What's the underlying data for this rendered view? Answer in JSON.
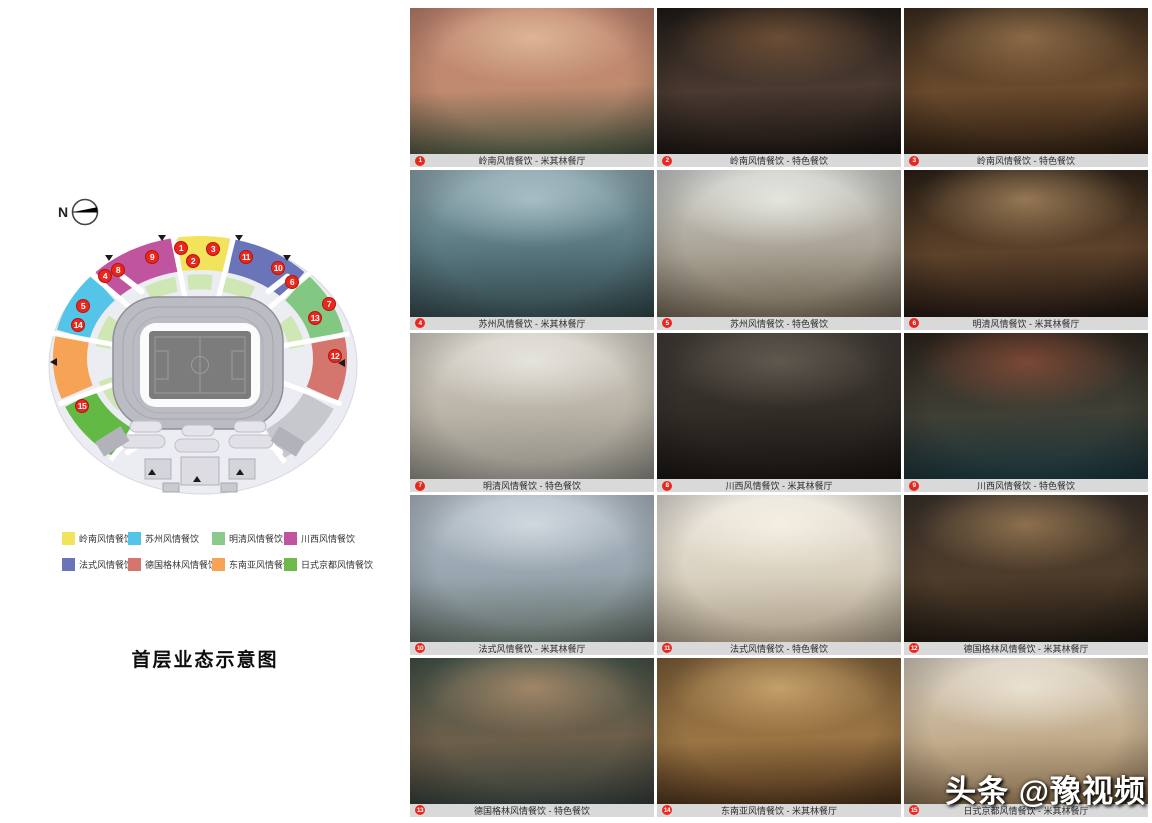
{
  "map_panel": {
    "north_label": "N",
    "title": "首层业态示意图",
    "colors": {
      "lingnan_yellow": "#f2e35c",
      "suzhou_cyan": "#55c4e9",
      "mingqing_green": "#82c882",
      "chuanxi_magenta": "#c0549e",
      "fashi_blue": "#6a74b8",
      "german_salmon": "#d4766e",
      "dongnanya_orange": "#f6a356",
      "rishi_green": "#62b944",
      "inner_ring_green": "#cfe7b4",
      "concourse": "#ececf3",
      "service_gray": "#c7c7ce",
      "badge_red": "#e8281e"
    },
    "legend": {
      "items": [
        {
          "label": "岭南风情餐饮",
          "color": "#f2e35c"
        },
        {
          "label": "苏州风情餐饮",
          "color": "#55c4e9"
        },
        {
          "label": "明清风情餐饮",
          "color": "#8cc98f"
        },
        {
          "label": "川西风情餐饮",
          "color": "#c0549e"
        },
        {
          "label": "法式风情餐饮",
          "color": "#6a74b8"
        },
        {
          "label": "德国格林风情餐饮",
          "color": "#d4766e"
        },
        {
          "label": "东南亚风情餐饮",
          "color": "#f6a356"
        },
        {
          "label": "日式京都风情餐饮",
          "color": "#6cbb4a"
        }
      ]
    },
    "badges": [
      {
        "n": "1",
        "x": 136,
        "y": 23
      },
      {
        "n": "2",
        "x": 148,
        "y": 36
      },
      {
        "n": "3",
        "x": 168,
        "y": 24
      },
      {
        "n": "4",
        "x": 60,
        "y": 51
      },
      {
        "n": "5",
        "x": 38,
        "y": 81
      },
      {
        "n": "6",
        "x": 247,
        "y": 57
      },
      {
        "n": "7",
        "x": 284,
        "y": 79
      },
      {
        "n": "8",
        "x": 73,
        "y": 45
      },
      {
        "n": "9",
        "x": 107,
        "y": 32
      },
      {
        "n": "10",
        "x": 233,
        "y": 43
      },
      {
        "n": "11",
        "x": 201,
        "y": 32
      },
      {
        "n": "12",
        "x": 290,
        "y": 131
      },
      {
        "n": "13",
        "x": 270,
        "y": 93
      },
      {
        "n": "14",
        "x": 33,
        "y": 100
      },
      {
        "n": "15",
        "x": 37,
        "y": 181
      }
    ]
  },
  "gallery": {
    "caption_bg": "#d9d9d9",
    "badge_color": "#e8281e",
    "photos": [
      {
        "num": "1",
        "caption": "岭南风情餐饮 - 米其林餐厅",
        "palette": [
          "#bf8470",
          "#c08a6e",
          "#44523f"
        ],
        "glow": "rgba(244,220,180,0.55)"
      },
      {
        "num": "2",
        "caption": "岭南风情餐饮 - 特色餐饮",
        "palette": [
          "#1f1a17",
          "#4a3a30",
          "#171210"
        ],
        "glow": "rgba(220,150,90,0.35)"
      },
      {
        "num": "3",
        "caption": "岭南风情餐饮 - 特色餐饮",
        "palette": [
          "#3a2c1f",
          "#6a4a2c",
          "#281b10"
        ],
        "glow": "rgba(230,180,120,0.4)"
      },
      {
        "num": "4",
        "caption": "苏州风情餐饮 - 米其林餐厅",
        "palette": [
          "#8fa9b0",
          "#57767e",
          "#2f4347"
        ],
        "glow": "rgba(210,230,235,0.5)"
      },
      {
        "num": "5",
        "caption": "苏州风情餐饮 - 特色餐饮",
        "palette": [
          "#cdd0cd",
          "#a9a294",
          "#6b5f4e"
        ],
        "glow": "rgba(255,255,250,0.6)"
      },
      {
        "num": "6",
        "caption": "明清风情餐饮 - 米其林餐厅",
        "palette": [
          "#2b2017",
          "#5d422a",
          "#1d1410"
        ],
        "glow": "rgba(255,210,150,0.45)"
      },
      {
        "num": "7",
        "caption": "明清风情餐饮 - 特色餐饮",
        "palette": [
          "#d7d3ca",
          "#b9b3a6",
          "#8c8a82"
        ],
        "glow": "rgba(255,255,255,0.5)"
      },
      {
        "num": "8",
        "caption": "川西风情餐饮 - 米其林餐厅",
        "palette": [
          "#413c36",
          "#322c27",
          "#16120f"
        ],
        "glow": "rgba(200,190,170,0.25)"
      },
      {
        "num": "9",
        "caption": "川西风情餐饮 - 特色餐饮",
        "palette": [
          "#2c241d",
          "#3f3f35",
          "#17333a"
        ],
        "glow": "rgba(255,120,80,0.35)"
      },
      {
        "num": "10",
        "caption": "法式风情餐饮 - 米其林餐厅",
        "palette": [
          "#b4bec8",
          "#97a5ae",
          "#5e6a62"
        ],
        "glow": "rgba(240,245,250,0.55)"
      },
      {
        "num": "11",
        "caption": "法式风情餐饮 - 特色餐饮",
        "palette": [
          "#eae6de",
          "#d9d0bf",
          "#a89a84"
        ],
        "glow": "rgba(255,250,235,0.6)"
      },
      {
        "num": "12",
        "caption": "德国格林风情餐饮 - 米其林餐厅",
        "palette": [
          "#38302a",
          "#4e3c2a",
          "#1c1610"
        ],
        "glow": "rgba(255,200,130,0.4)"
      },
      {
        "num": "13",
        "caption": "德国格林风情餐饮 - 特色餐饮",
        "palette": [
          "#435349",
          "#6d5f4a",
          "#323c38"
        ],
        "glow": "rgba(255,190,140,0.45)"
      },
      {
        "num": "14",
        "caption": "东南亚风情餐饮 - 米其林餐厅",
        "palette": [
          "#7d5f39",
          "#9a7443",
          "#452d18"
        ],
        "glow": "rgba(255,215,150,0.5)"
      },
      {
        "num": "15",
        "caption": "日式京都风情餐饮 - 米其林餐厅",
        "palette": [
          "#d9d0c1",
          "#c2ac8c",
          "#7e6648"
        ],
        "glow": "rgba(255,250,240,0.55)"
      }
    ]
  },
  "watermark": {
    "text": "头条 @豫视频"
  }
}
